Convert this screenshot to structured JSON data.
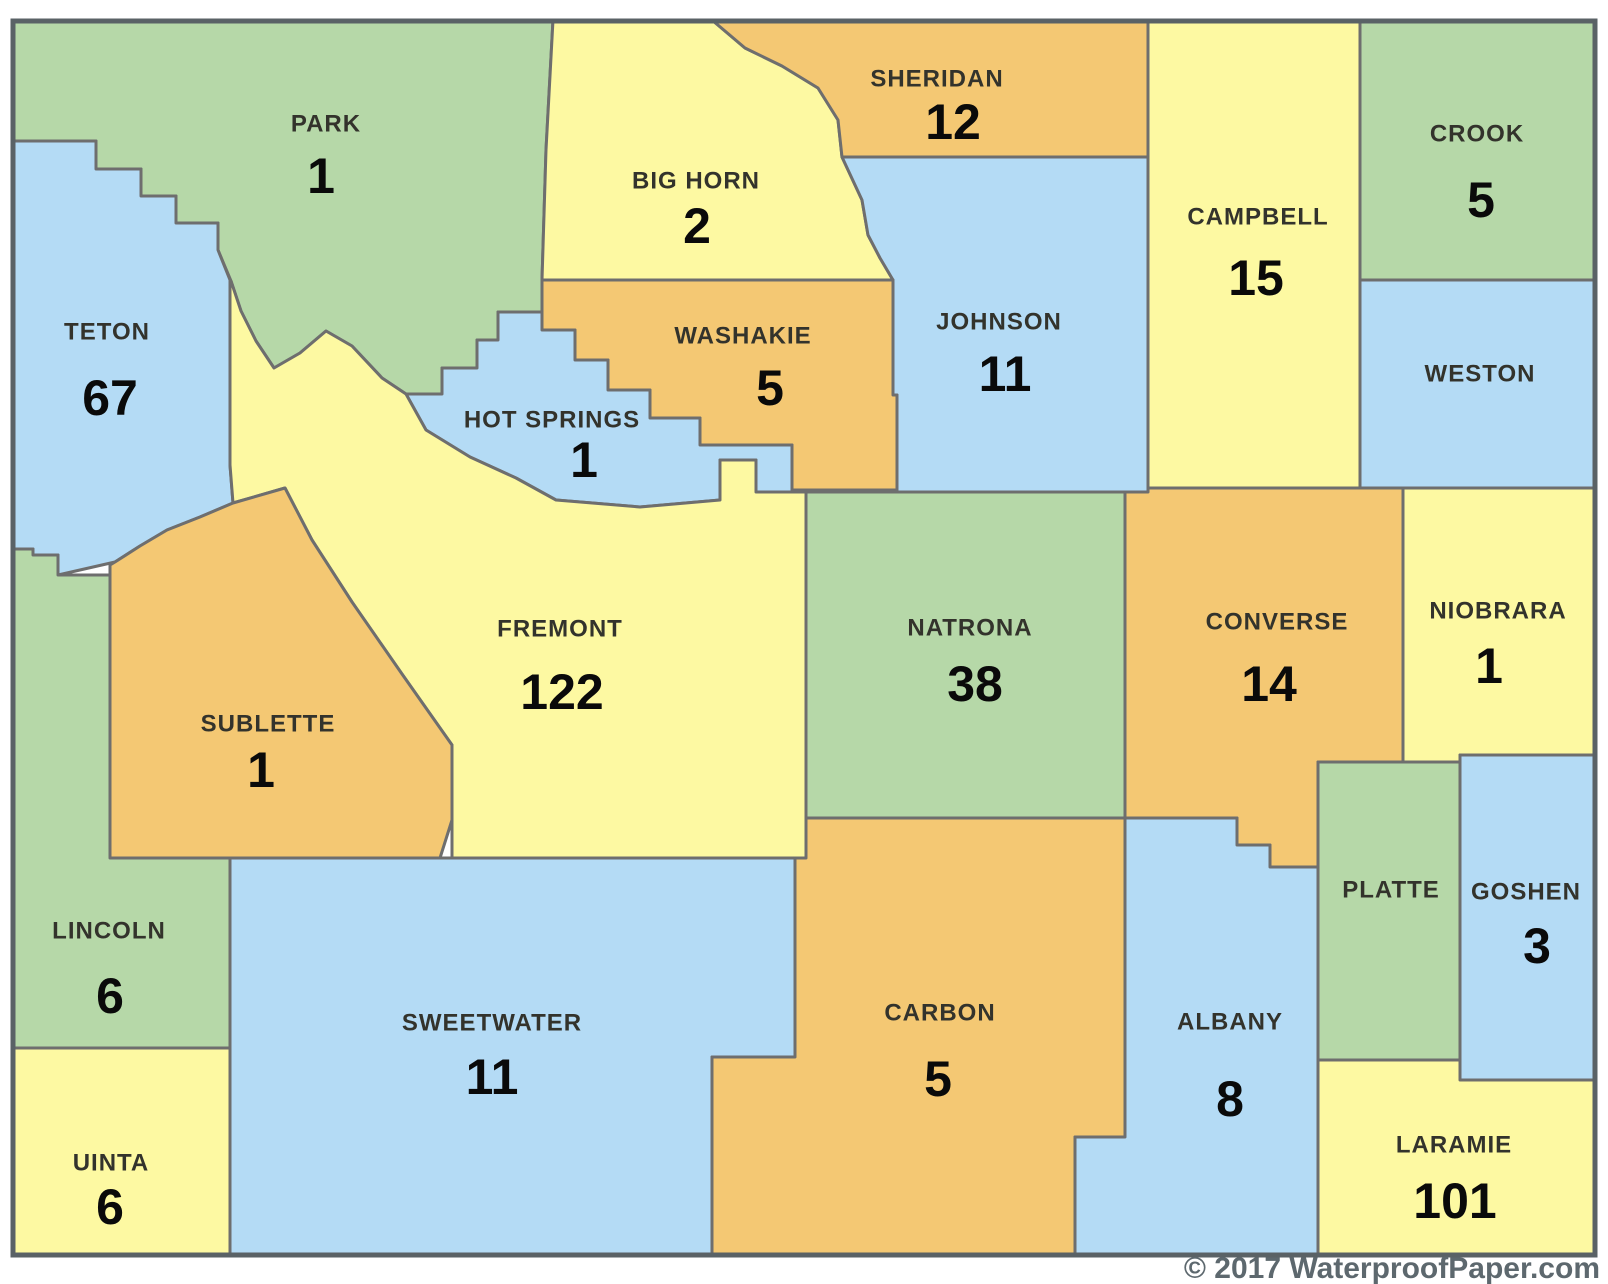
{
  "map": {
    "region": "Wyoming counties",
    "copyright": "© 2017 WaterproofPaper.com",
    "palette": {
      "green": "#b6d8a8",
      "blue": "#b4dbf5",
      "yellow": "#fdf9a2",
      "orange": "#f4c873"
    },
    "county_border_color": "#6e6e6e",
    "frame_color": "#5a6266",
    "background_color": "#ffffff",
    "name_text_color": "#33332c",
    "value_text_color": "#0a0a0a",
    "counties": [
      {
        "id": "park",
        "name": "PARK",
        "value": "1",
        "color": "green",
        "name_pos": [
          326,
          124
        ],
        "value_pos": [
          321,
          176
        ],
        "points": "12,20 553,20 546,150 542,280 542,312 498,312 498,340 477,340 477,368 442,368 442,394 406,394 382,378 352,346 326,331 300,353 274,368 256,341 241,311 231,281 218,250 218,223 176,223 176,196 141,196 141,169 96,169 96,141 12,141"
      },
      {
        "id": "teton",
        "name": "TETON",
        "value": "67",
        "color": "blue",
        "name_pos": [
          107,
          332
        ],
        "value_pos": [
          110,
          398
        ],
        "points": "12,141 96,141 96,169 141,169 141,196 176,196 176,223 218,223 218,250 230,280 230,465 233,503 200,517 167,530 140,546 115,562 58,575 58,555 33,555 33,549 12,549"
      },
      {
        "id": "big-horn",
        "name": "BIG HORN",
        "value": "2",
        "color": "yellow",
        "name_pos": [
          696,
          181
        ],
        "value_pos": [
          697,
          226
        ],
        "points": "553,20 712,20 745,48 782,66 818,88 838,120 842,157 862,200 868,235 880,258 893,280 542,280 546,150"
      },
      {
        "id": "sheridan",
        "name": "SHERIDAN",
        "value": "12",
        "color": "orange",
        "name_pos": [
          937,
          79
        ],
        "value_pos": [
          953,
          122
        ],
        "points": "712,20 1148,20 1148,157 842,157 838,120 818,88 782,66 745,48"
      },
      {
        "id": "campbell",
        "name": "CAMPBELL",
        "value": "15",
        "color": "yellow",
        "name_pos": [
          1258,
          217
        ],
        "value_pos": [
          1256,
          278
        ],
        "points": "1148,20 1360,20 1360,488 1148,488"
      },
      {
        "id": "crook",
        "name": "CROOK",
        "value": "5",
        "color": "green",
        "name_pos": [
          1477,
          134
        ],
        "value_pos": [
          1481,
          200
        ],
        "points": "1360,20 1596,20 1596,280 1360,280"
      },
      {
        "id": "weston",
        "name": "WESTON",
        "value": "",
        "color": "blue",
        "name_pos": [
          1480,
          374
        ],
        "value_pos": null,
        "points": "1360,280 1596,280 1596,488 1360,488"
      },
      {
        "id": "johnson",
        "name": "JOHNSON",
        "value": "11",
        "color": "blue",
        "name_pos": [
          999,
          322
        ],
        "value_pos": [
          1005,
          374
        ],
        "points": "842,157 1148,157 1148,492 897,492 897,395 893,395 893,280 880,258 868,235 862,200"
      },
      {
        "id": "washakie",
        "name": "WASHAKIE",
        "value": "5",
        "color": "orange",
        "name_pos": [
          743,
          336
        ],
        "value_pos": [
          770,
          388
        ],
        "points": "542,280 893,280 893,395 897,395 897,490 792,490 792,445 700,445 700,418 650,418 650,390 608,390 608,360 575,360 575,330 542,330 542,312"
      },
      {
        "id": "hot-springs",
        "name": "HOT SPRINGS",
        "value": "1",
        "color": "blue",
        "name_pos": [
          552,
          420
        ],
        "value_pos": [
          584,
          460
        ],
        "points": "498,312 542,312 542,330 575,330 575,360 608,360 608,390 650,390 650,418 700,418 700,445 792,445 792,492 756,492 756,460 720,460 720,500 640,507 556,500 516,478 470,457 426,430 406,394 442,394 442,368 477,368 477,340 498,340"
      },
      {
        "id": "fremont",
        "name": "FREMONT",
        "value": "122",
        "color": "yellow",
        "name_pos": [
          560,
          629
        ],
        "value_pos": [
          562,
          692
        ],
        "points": "230,280 231,281 241,311 256,341 274,368 300,353 326,331 352,346 382,378 406,394 426,430 470,457 516,478 556,500 640,507 720,500 720,460 756,460 756,492 806,492 806,858 452,858 452,745 402,674 352,602 312,540 285,488 233,503 230,465"
      },
      {
        "id": "sublette",
        "name": "SUBLETTE",
        "value": "1",
        "color": "orange",
        "name_pos": [
          268,
          724
        ],
        "value_pos": [
          261,
          770
        ],
        "points": "115,562 140,546 167,530 200,517 233,503 285,488 312,540 352,602 402,674 452,745 452,820 440,858 110,858 110,565"
      },
      {
        "id": "natrona",
        "name": "NATRONA",
        "value": "38",
        "color": "green",
        "name_pos": [
          970,
          628
        ],
        "value_pos": [
          975,
          684
        ],
        "points": "806,492 1125,492 1125,818 806,818"
      },
      {
        "id": "converse",
        "name": "CONVERSE",
        "value": "14",
        "color": "orange",
        "name_pos": [
          1277,
          622
        ],
        "value_pos": [
          1269,
          684
        ],
        "points": "1125,492 1148,492 1148,488 1403,488 1403,762 1318,762 1318,867 1270,867 1270,845 1237,845 1237,818 1125,818"
      },
      {
        "id": "niobrara",
        "name": "NIOBRARA",
        "value": "1",
        "color": "yellow",
        "name_pos": [
          1498,
          611
        ],
        "value_pos": [
          1489,
          666
        ],
        "points": "1403,488 1596,488 1596,755 1460,755 1460,762 1403,762"
      },
      {
        "id": "lincoln",
        "name": "LINCOLN",
        "value": "6",
        "color": "green",
        "name_pos": [
          109,
          931
        ],
        "value_pos": [
          110,
          996
        ],
        "points": "12,549 33,549 33,555 58,555 58,575 110,575 110,858 230,858 230,1048 12,1048"
      },
      {
        "id": "uinta",
        "name": "UINTA",
        "value": "6",
        "color": "yellow",
        "name_pos": [
          111,
          1163
        ],
        "value_pos": [
          110,
          1207
        ],
        "points": "12,1048 230,1048 230,1256 12,1256"
      },
      {
        "id": "sweetwater",
        "name": "SWEETWATER",
        "value": "11",
        "color": "blue",
        "name_pos": [
          492,
          1023
        ],
        "value_pos": [
          492,
          1077
        ],
        "points": "230,858 795,858 795,1057 712,1057 712,1256 230,1256"
      },
      {
        "id": "carbon",
        "name": "CARBON",
        "value": "5",
        "color": "orange",
        "name_pos": [
          940,
          1013
        ],
        "value_pos": [
          938,
          1079
        ],
        "points": "806,818 1125,818 1125,1137 1075,1137 1075,1256 712,1256 712,1057 795,1057 795,858 806,858"
      },
      {
        "id": "albany",
        "name": "ALBANY",
        "value": "8",
        "color": "blue",
        "name_pos": [
          1230,
          1022
        ],
        "value_pos": [
          1230,
          1099
        ],
        "points": "1125,818 1237,818 1237,845 1270,845 1270,867 1318,867 1318,1256 1075,1256 1075,1137 1125,1137"
      },
      {
        "id": "platte",
        "name": "PLATTE",
        "value": "",
        "color": "green",
        "name_pos": [
          1391,
          890
        ],
        "value_pos": null,
        "points": "1318,762 1460,762 1460,1060 1318,1060"
      },
      {
        "id": "goshen",
        "name": "GOSHEN",
        "value": "3",
        "color": "blue",
        "name_pos": [
          1526,
          892
        ],
        "value_pos": [
          1537,
          946
        ],
        "points": "1460,755 1596,755 1596,1080 1460,1080"
      },
      {
        "id": "laramie",
        "name": "LARAMIE",
        "value": "101",
        "color": "yellow",
        "name_pos": [
          1454,
          1145
        ],
        "value_pos": [
          1455,
          1201
        ],
        "points": "1318,1060 1460,1060 1460,1080 1596,1080 1596,1256 1318,1256"
      }
    ]
  }
}
